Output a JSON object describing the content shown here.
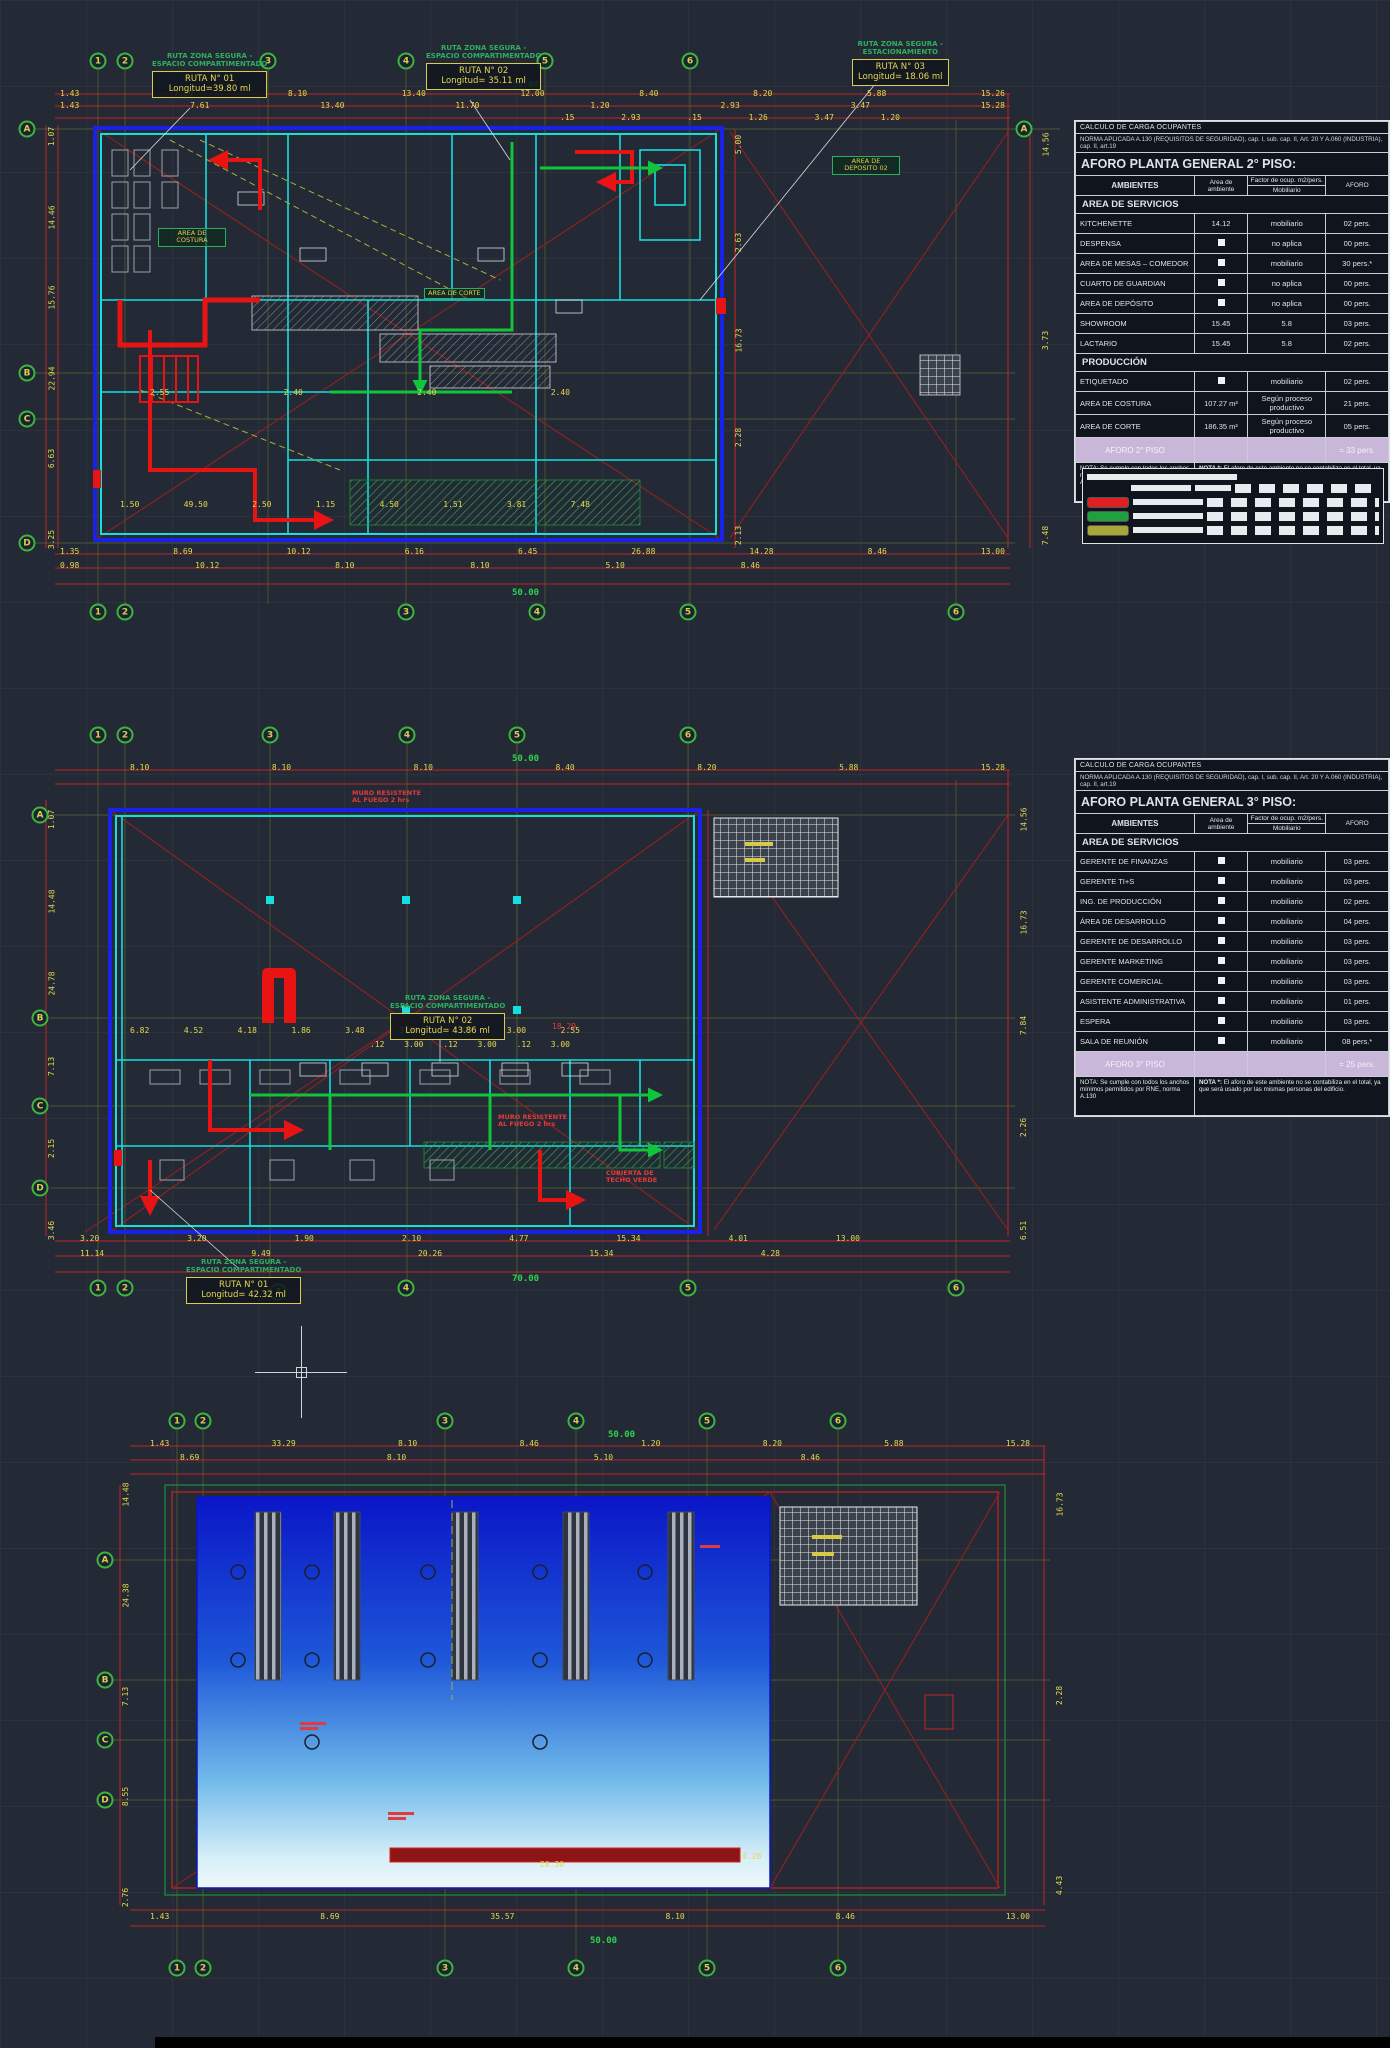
{
  "canvas": {
    "bg": "#242a35"
  },
  "tables": {
    "floor2": {
      "header1": "CALCULO DE CARGA OCUPANTES",
      "header2": "NORMA APLICADA A.130 (REQUISITOS DE SEGURIDAD), cap. I, sub. cap. II, Art. 20 Y A.060 (INDUSTRIA), cap. II, art.19",
      "title": "AFORO PLANTA GENERAL  2° PISO:",
      "col_ambientes": "AMBIENTES",
      "col_area": "Area de ambiente",
      "col_factor": "Factor de ocup. m2/pers.",
      "col_factor_sub": "Mobiliario",
      "col_aforo": "AFORO",
      "rows": [
        {
          "section": "AREA DE SERVICIOS"
        },
        {
          "name": "KITCHENETTE",
          "area": "14.12",
          "factor": "mobiliario",
          "aforo": "02 pers."
        },
        {
          "name": "DESPENSA",
          "area": "■",
          "factor": "no aplica",
          "aforo": "00 pers."
        },
        {
          "name": "AREA DE MESAS – COMEDOR",
          "area": "■",
          "factor": "mobiliario",
          "aforo": "30 pers.*"
        },
        {
          "name": "CUARTO DE GUARDIAN",
          "area": "■",
          "factor": "no aplica",
          "aforo": "00 pers."
        },
        {
          "name": "AREA DE DEPÓSITO",
          "area": "■",
          "factor": "no aplica",
          "aforo": "00 pers."
        },
        {
          "name": "SHOWROOM",
          "area": "15.45",
          "factor": "5.8",
          "aforo": "03 pers."
        },
        {
          "name": "LACTARIO",
          "area": "15.45",
          "factor": "5.8",
          "aforo": "02 pers."
        },
        {
          "section": "PRODUCCIÓN"
        },
        {
          "name": "ETIQUETADO",
          "area": "■",
          "factor": "mobiliario",
          "aforo": "02 pers."
        },
        {
          "name": "AREA DE COSTURA",
          "area": "107.27 m²",
          "factor": "Según proceso productivo",
          "aforo": "21 pers."
        },
        {
          "name": "AREA DE CORTE",
          "area": "186.35 m²",
          "factor": "Según proceso productivo",
          "aforo": "05 pers."
        },
        {
          "total": "AFORO 2° PISO",
          "aforo": "= 33 pers."
        }
      ],
      "nota1": "NOTA: Se cumple con todos los anchos mínimos permitidos por RNE, norma A.130",
      "nota2_title": "NOTA *:",
      "nota2": "El aforo de este ambiente no se contabiliza en el total, ya que será usado por las mismas personas de edificio."
    },
    "floor3": {
      "header1": "CALCULO DE CARGA OCUPANTES",
      "header2": "NORMA APLICADA A.130 (REQUISITOS DE SEGURIDAD), cap. I, sub. cap. II, Art. 20 Y A.060 (INDUSTRIA), cap. II, art.19",
      "title": "AFORO PLANTA GENERAL  3° PISO:",
      "col_ambientes": "AMBIENTES",
      "col_area": "Area de ambiente",
      "col_factor": "Factor de ocup. m2/pers.",
      "col_factor_sub": "Mobiliario",
      "col_aforo": "AFORO",
      "rows": [
        {
          "section": "AREA DE SERVICIOS"
        },
        {
          "name": "GERENTE DE FINANZAS",
          "area": "■",
          "factor": "mobiliario",
          "aforo": "03 pers."
        },
        {
          "name": "GERENTE TI+S",
          "area": "■",
          "factor": "mobiliario",
          "aforo": "03 pers."
        },
        {
          "name": "ING. DE PRODUCCIÓN",
          "area": "■",
          "factor": "mobiliario",
          "aforo": "02 pers."
        },
        {
          "name": "ÁREA DE DESARROLLO",
          "area": "■",
          "factor": "mobiliario",
          "aforo": "04 pers."
        },
        {
          "name": "GERENTE DE DESARROLLO",
          "area": "■",
          "factor": "mobiliario",
          "aforo": "03 pers."
        },
        {
          "name": "GERENTE MARKETING",
          "area": "■",
          "factor": "mobiliario",
          "aforo": "03 pers."
        },
        {
          "name": "GERENTE COMERCIAL",
          "area": "■",
          "factor": "mobiliario",
          "aforo": "03 pers."
        },
        {
          "name": "ASISTENTE ADMINISTRATIVA",
          "area": "■",
          "factor": "mobiliario",
          "aforo": "01 pers."
        },
        {
          "name": "ESPERA",
          "area": "■",
          "factor": "mobiliario",
          "aforo": "03 pers."
        },
        {
          "name": "SALA DE REUNIÓN",
          "area": "■",
          "factor": "mobiliario",
          "aforo": "08 pers.*"
        },
        {
          "total": "AFORO 3° PISO",
          "aforo": "= 25 pers."
        }
      ],
      "nota1": "NOTA: Se cumple con todos los anchos mínimos permitidos por RNE, norma A.130",
      "nota2_title": "NOTA *:",
      "nota2": "El aforo de este ambiente no se contabiliza en el total, ya que será usado por las mismas personas del edificio."
    }
  },
  "legend": {
    "colors": [
      "#e02020",
      "#20a040",
      "#a8a838"
    ]
  },
  "plan2": {
    "callouts": [
      {
        "h1": "RUTA ZONA SEGURA -",
        "h2": "ESPACIO COMPARTIMENTADO",
        "l1": "RUTA N° 01",
        "l2": "Longitud=39.80 ml",
        "x": 152,
        "y": 52
      },
      {
        "h1": "RUTA ZONA SEGURA -",
        "h2": "ESPACIO COMPARTIMENTADO",
        "l1": "RUTA N° 02",
        "l2": "Longitud= 35.11 ml",
        "x": 426,
        "y": 44
      },
      {
        "h1": "RUTA ZONA SEGURA -",
        "h2": "ESTACIONAMIENTO",
        "l1": "RUTA N° 03",
        "l2": "Longitud= 18.06 ml",
        "x": 852,
        "y": 40
      }
    ],
    "room_labels": [
      {
        "t": "AREA DE COSTURA",
        "x": 158,
        "y": 228
      },
      {
        "t": "AREA DE CORTE",
        "x": 424,
        "y": 288
      },
      {
        "t": "AREA DE DEPOSITO 02",
        "x": 832,
        "y": 156
      }
    ],
    "bubbles": [
      {
        "t": "1",
        "x": 98,
        "y": 61
      },
      {
        "t": "2",
        "x": 125,
        "y": 61
      },
      {
        "t": "3",
        "x": 268,
        "y": 61
      },
      {
        "t": "4",
        "x": 406,
        "y": 61
      },
      {
        "t": "5",
        "x": 545,
        "y": 61
      },
      {
        "t": "6",
        "x": 690,
        "y": 61
      },
      {
        "t": "A",
        "x": 1024,
        "y": 129
      },
      {
        "t": "A",
        "x": 27,
        "y": 129
      },
      {
        "t": "B",
        "x": 27,
        "y": 373
      },
      {
        "t": "C",
        "x": 27,
        "y": 419
      },
      {
        "t": "D",
        "x": 27,
        "y": 543
      },
      {
        "t": "1",
        "x": 98,
        "y": 612
      },
      {
        "t": "2",
        "x": 125,
        "y": 612
      },
      {
        "t": "3",
        "x": 406,
        "y": 612
      },
      {
        "t": "4",
        "x": 537,
        "y": 612
      },
      {
        "t": "5",
        "x": 688,
        "y": 612
      },
      {
        "t": "6",
        "x": 956,
        "y": 612
      }
    ],
    "dims": {
      "top1": [
        "1.43",
        "7.89",
        "8.10",
        "13.40",
        "12.00",
        "8.40",
        "8.20",
        "5.88",
        "15.26"
      ],
      "top2": [
        "1.43",
        "7.61",
        "13.40",
        "11.70",
        "1.20",
        "2.93",
        "3.47",
        "15.28"
      ],
      "top3": [
        ".15",
        "2.93",
        ".15",
        "1.26",
        "3.47",
        "1.20"
      ],
      "overall_top": "50.00",
      "left": [
        "1.07",
        "14.46",
        "15.76",
        "22.94",
        "6.63",
        "3.25"
      ],
      "right_in": [
        "5.00",
        "2.63",
        "16.73",
        "2.28",
        "2.13"
      ],
      "right_out": [
        "14.56",
        "3.73",
        "7.48"
      ],
      "inner_a": [
        "2.55",
        "2.40",
        "2.40",
        "2.40"
      ],
      "inner_b": [
        "1.50",
        "49.50",
        "2.50",
        "1.15",
        "4.50",
        "1.51",
        "3.81",
        "7.48"
      ],
      "bottom1": [
        "1.35",
        "8.69",
        "10.12",
        "6.16",
        "6.45",
        "26.88",
        "14.28",
        "8.46",
        "13.00"
      ],
      "bottom2": [
        "0.98",
        "10.12",
        "8.10",
        "8.10",
        "5.10",
        "8.46"
      ],
      "overall_bottom": "50.00"
    }
  },
  "plan3": {
    "callouts": [
      {
        "h1": "RUTA ZONA SEGURA -",
        "h2": "ESPACIO COMPARTIMENTADO",
        "l1": "RUTA N° 02",
        "l2": "Longitud= 43.86 ml",
        "x": 390,
        "y": 994
      },
      {
        "h1": "RUTA ZONA SEGURA -",
        "h2": "ESPACIO COMPARTIMENTADO",
        "l1": "RUTA N° 01",
        "l2": "Longitud= 42.32 ml",
        "x": 186,
        "y": 1258
      }
    ],
    "labels": [
      {
        "t": "MURO RESISTENTE",
        "t2": "AL FUEGO 2 hrs",
        "x": 352,
        "y": 790
      },
      {
        "t": "MURO RESISTENTE",
        "t2": "AL FUEGO 2 hrs",
        "x": 498,
        "y": 1114
      },
      {
        "t": "CUBIERTA DE",
        "t2": "TECHO VERDE",
        "x": 606,
        "y": 1170
      }
    ],
    "bubbles": [
      {
        "t": "1",
        "x": 98,
        "y": 735
      },
      {
        "t": "2",
        "x": 125,
        "y": 735
      },
      {
        "t": "3",
        "x": 270,
        "y": 735
      },
      {
        "t": "4",
        "x": 407,
        "y": 735
      },
      {
        "t": "5",
        "x": 517,
        "y": 735
      },
      {
        "t": "6",
        "x": 688,
        "y": 735
      },
      {
        "t": "A",
        "x": 40,
        "y": 815
      },
      {
        "t": "B",
        "x": 40,
        "y": 1018
      },
      {
        "t": "C",
        "x": 40,
        "y": 1106
      },
      {
        "t": "D",
        "x": 40,
        "y": 1188
      },
      {
        "t": "1",
        "x": 98,
        "y": 1288
      },
      {
        "t": "2",
        "x": 125,
        "y": 1288
      },
      {
        "t": "3",
        "x": 278,
        "y": 1292
      },
      {
        "t": "4",
        "x": 406,
        "y": 1288
      },
      {
        "t": "5",
        "x": 688,
        "y": 1288
      },
      {
        "t": "6",
        "x": 956,
        "y": 1288
      }
    ],
    "dims": {
      "top1": [
        "8.10",
        "8.10",
        "8.10",
        "8.40",
        "8.20",
        "5.88",
        "15.28"
      ],
      "overall_top": "50.00",
      "left": [
        "1.07",
        "14.48",
        "24.78",
        "7.13",
        "2.15",
        "3.46"
      ],
      "right": [
        "14.56",
        "16.73",
        "7.84",
        "2.26",
        "6.51"
      ],
      "inner1": [
        "6.82",
        "4.52",
        "4.18",
        "1.86",
        "3.48",
        "3.00",
        "3.00",
        "3.00",
        "2.55"
      ],
      "inner2": [
        ".12",
        "3.00",
        ".12",
        "3.00",
        ".12",
        "3.00"
      ],
      "inner_red": "18.29",
      "bottom1": [
        "3.20",
        "3.20",
        "1.90",
        "2.10",
        "4.77",
        "15.34",
        "4.01",
        "13.00"
      ],
      "bottom2": [
        "11.14",
        "9.49",
        "20.26",
        "15.34",
        "4.28"
      ],
      "overall_bottom": "70.00"
    }
  },
  "roof": {
    "bubbles": [
      {
        "t": "1",
        "x": 177,
        "y": 1421
      },
      {
        "t": "2",
        "x": 203,
        "y": 1421
      },
      {
        "t": "3",
        "x": 445,
        "y": 1421
      },
      {
        "t": "4",
        "x": 576,
        "y": 1421
      },
      {
        "t": "5",
        "x": 707,
        "y": 1421
      },
      {
        "t": "6",
        "x": 838,
        "y": 1421
      },
      {
        "t": "A",
        "x": 105,
        "y": 1560
      },
      {
        "t": "B",
        "x": 105,
        "y": 1680
      },
      {
        "t": "C",
        "x": 105,
        "y": 1740
      },
      {
        "t": "D",
        "x": 105,
        "y": 1800
      },
      {
        "t": "1",
        "x": 177,
        "y": 1968
      },
      {
        "t": "2",
        "x": 203,
        "y": 1968
      },
      {
        "t": "3",
        "x": 445,
        "y": 1968
      },
      {
        "t": "4",
        "x": 576,
        "y": 1968
      },
      {
        "t": "5",
        "x": 707,
        "y": 1968
      },
      {
        "t": "6",
        "x": 838,
        "y": 1968
      }
    ],
    "dims": {
      "top1": [
        "1.43",
        "33.29",
        "8.10",
        "8.46",
        "1.20",
        "8.20",
        "5.88",
        "15.28"
      ],
      "top2": [
        "8.69",
        "8.10",
        "5.10",
        "8.46"
      ],
      "overall_top": "50.00",
      "left": [
        "14.48",
        "24.38",
        "7.13",
        "8.55",
        "2.76"
      ],
      "right": [
        "16.73",
        "2.28",
        "4.43"
      ],
      "inner_a": "20.30",
      "inner_b": "4.28",
      "bottom1": [
        "1.43",
        "8.69",
        "35.57",
        "8.10",
        "8.46",
        "13.00"
      ],
      "overall_bottom": "50.00"
    }
  }
}
